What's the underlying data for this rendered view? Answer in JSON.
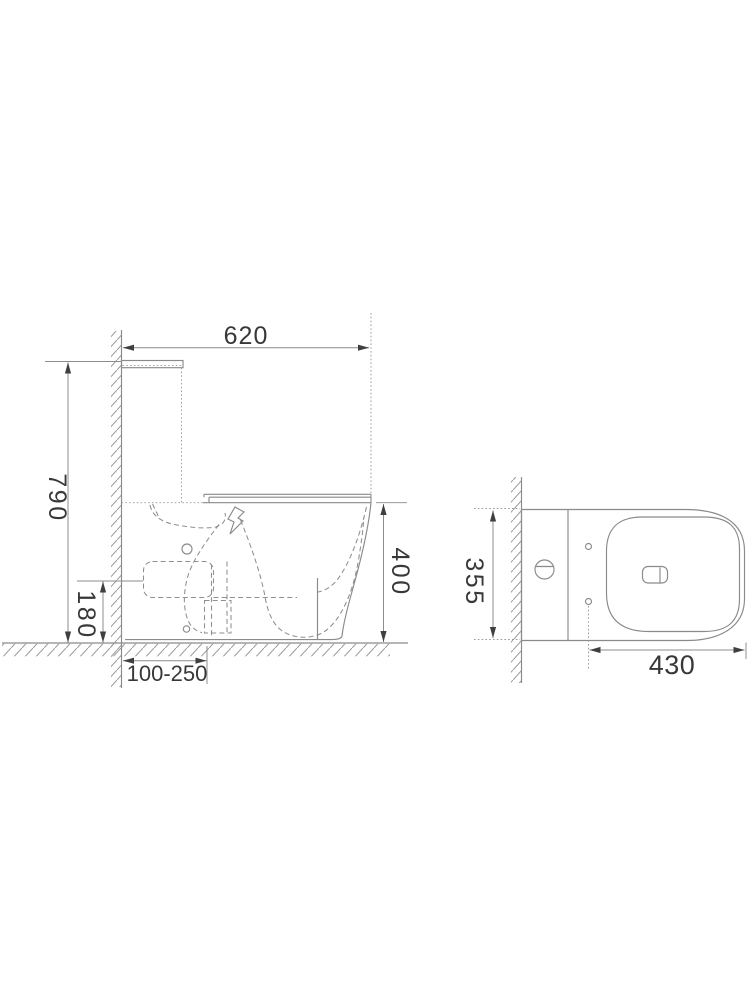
{
  "dimensions": {
    "side": {
      "width": "620",
      "height": "790",
      "outlet_height": "180",
      "bowl_height": "400",
      "rough_in": "100-250"
    },
    "plan": {
      "width": "355",
      "length": "430"
    }
  },
  "colors": {
    "line": "#8a8a8a",
    "dimension_text": "#383838",
    "arrow": "#3f3f3f",
    "background": "#ffffff"
  }
}
